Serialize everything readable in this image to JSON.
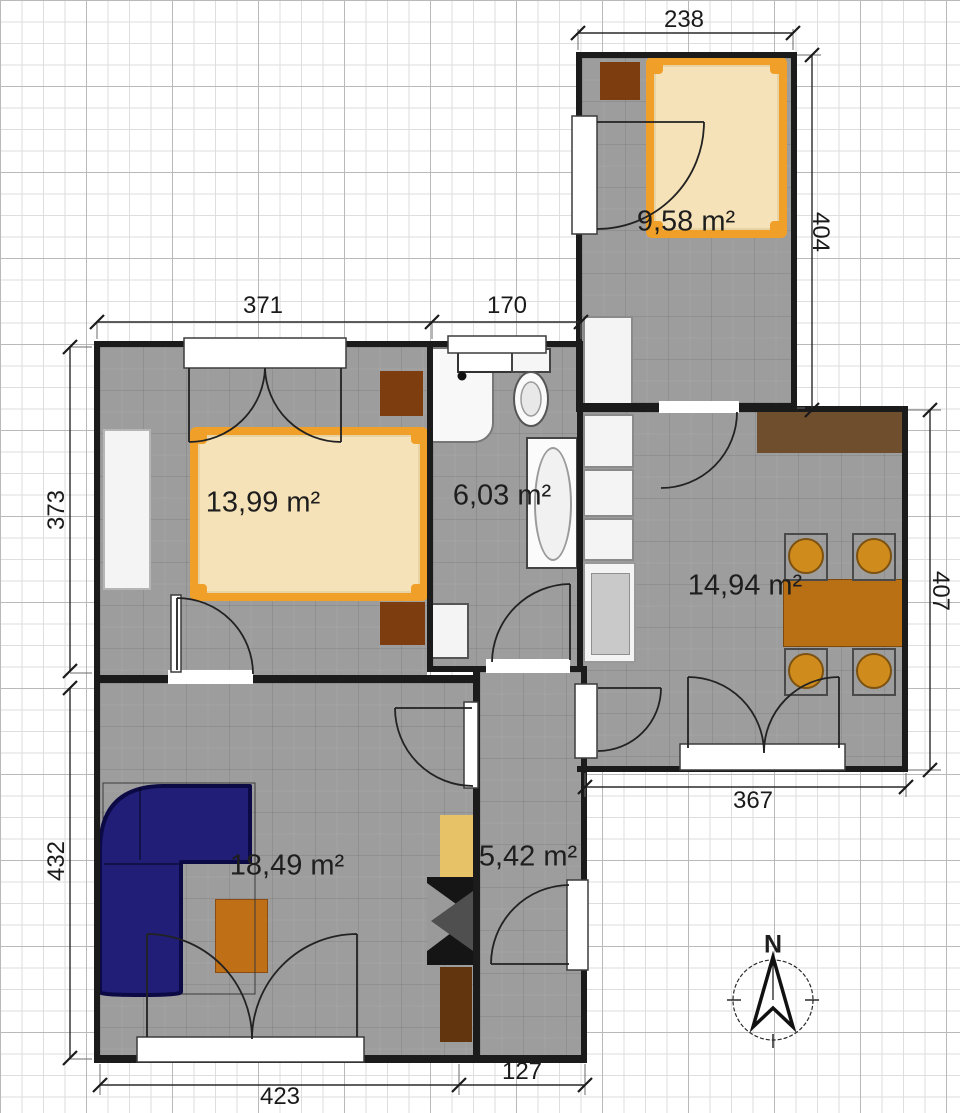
{
  "rooms": [
    {
      "id": "bedroom-small",
      "area_label": "9,58 m²"
    },
    {
      "id": "bedroom-large",
      "area_label": "13,99 m²"
    },
    {
      "id": "bathroom",
      "area_label": "6,03 m²"
    },
    {
      "id": "kitchen-dining",
      "area_label": "14,94 m²"
    },
    {
      "id": "living-room",
      "area_label": "18,49 m²"
    },
    {
      "id": "hallway",
      "area_label": "5,42 m²"
    }
  ],
  "dimensions": [
    {
      "id": "top-bedroom-width",
      "value": "238"
    },
    {
      "id": "top-bedroom-height",
      "value": "404"
    },
    {
      "id": "bedroom-width",
      "value": "371"
    },
    {
      "id": "bathroom-width",
      "value": "170"
    },
    {
      "id": "bedroom-height",
      "value": "373"
    },
    {
      "id": "kitchen-height",
      "value": "407"
    },
    {
      "id": "kitchen-width",
      "value": "367"
    },
    {
      "id": "living-height",
      "value": "432"
    },
    {
      "id": "living-width",
      "value": "423"
    },
    {
      "id": "hallway-width",
      "value": "127"
    }
  ],
  "compass": {
    "north_label": "N"
  },
  "colors": {
    "floor": "#9d9d9d",
    "wall": "#1b1b1b",
    "bed_frame": "#f0a028",
    "mattress": "#f6e2b8",
    "nightstand": "#7d3d0e",
    "countertop": "#6f4e2d",
    "dining_table": "#b96f14",
    "chair": "#cf8c1c",
    "sofa": "#211e78",
    "coffee_table": "#bf6f16",
    "cabinet_tan": "#e8c266",
    "cabinet_brown": "#63350f"
  }
}
